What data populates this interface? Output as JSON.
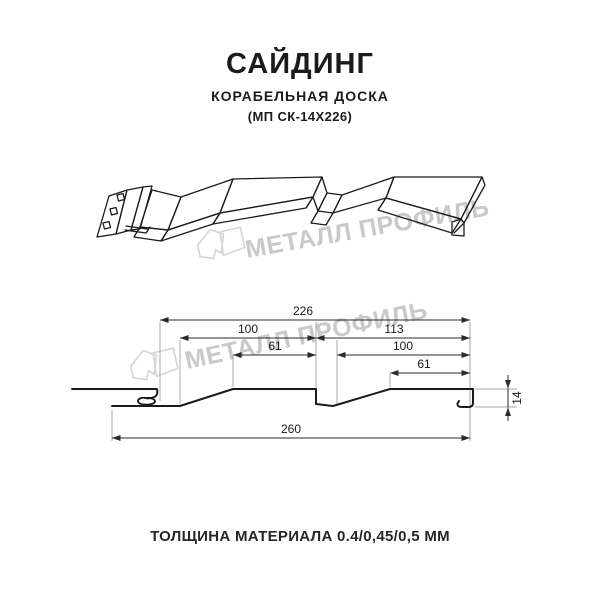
{
  "header": {
    "title": "САЙДИНГ",
    "subtitle": "КОРАБЕЛЬНАЯ ДОСКА",
    "product_code": "(МП СК-14Х226)"
  },
  "watermark": {
    "brand": "МЕТАЛЛ ПРОФИЛЬ",
    "color": "#c9c9c9"
  },
  "dimensions": {
    "coverage_width": "226",
    "left_panel_width": "100",
    "right_panel_width": "113",
    "left_panel_top": "61",
    "right_panel_inner": "100",
    "right_panel_top": "61",
    "overall_width": "260",
    "profile_height": "14"
  },
  "footer": {
    "thickness": "ТОЛЩИНА МАТЕРИАЛА 0.4/0,45/0,5 ММ"
  },
  "colors": {
    "line": "#1a1a1a",
    "dimension_line": "#2b2b2b",
    "extension_line": "#a8a8a8",
    "watermark": "#c9c9c9",
    "background": "#ffffff"
  }
}
